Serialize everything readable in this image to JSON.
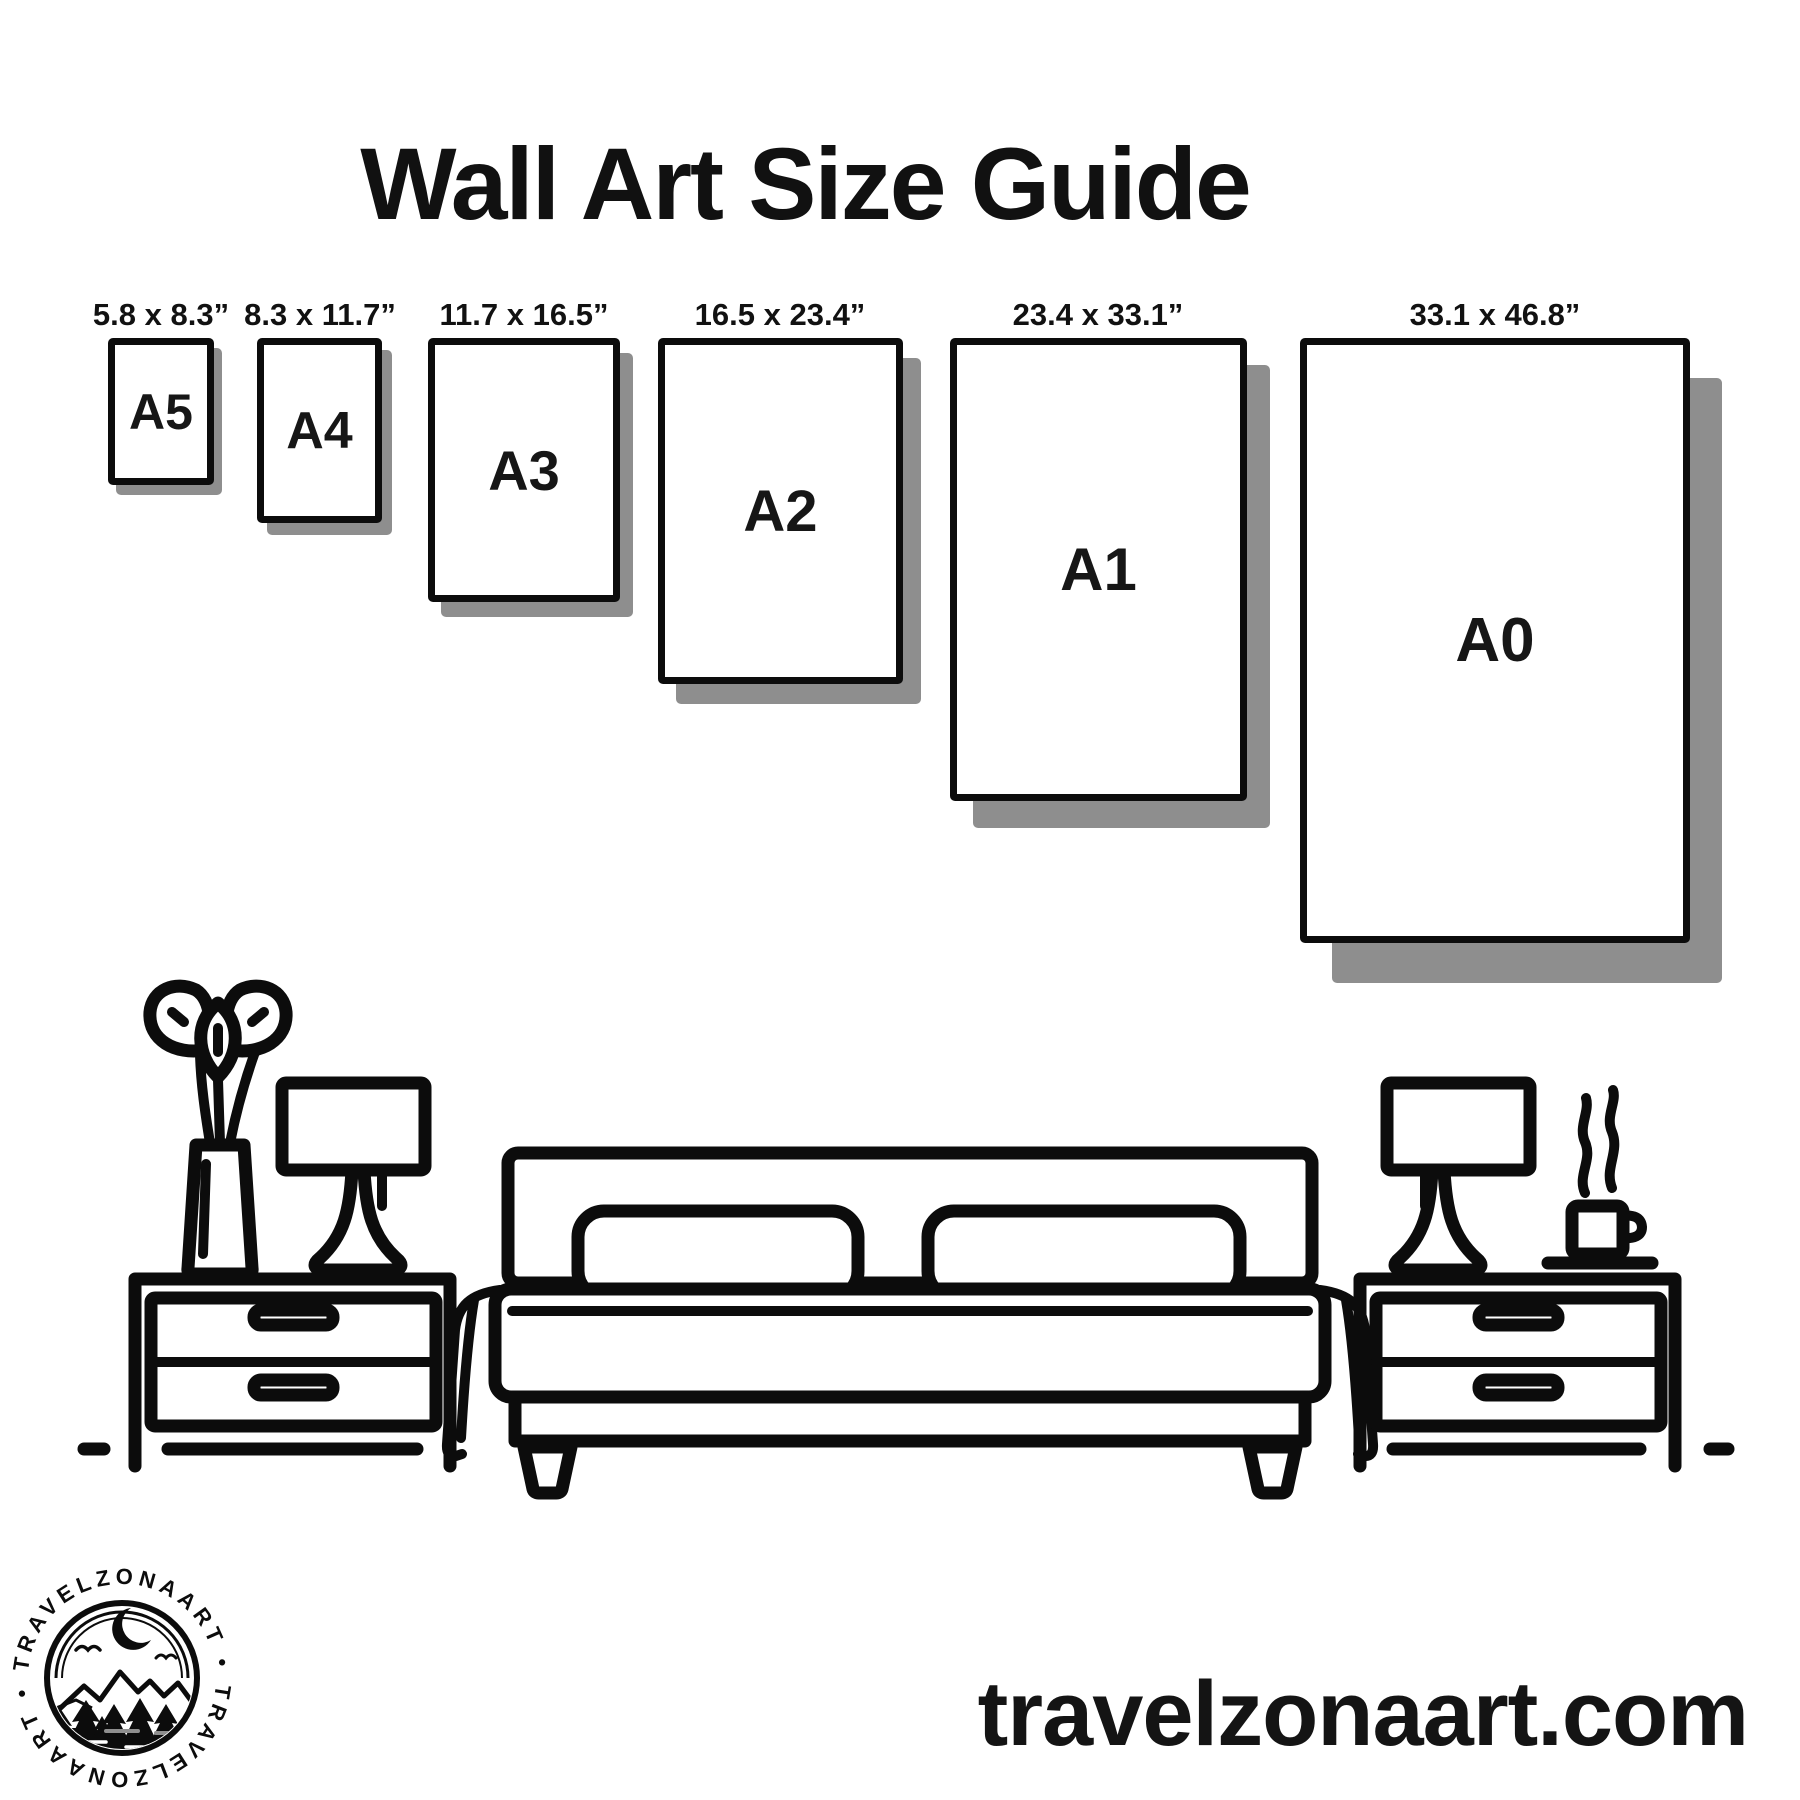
{
  "title": "Wall Art Size Guide",
  "sizes": [
    {
      "name": "A5",
      "dimensions": "5.8 x 8.3”"
    },
    {
      "name": "A4",
      "dimensions": "8.3 x 11.7”"
    },
    {
      "name": "A3",
      "dimensions": "11.7 x 16.5”"
    },
    {
      "name": "A2",
      "dimensions": "16.5 x 23.4”"
    },
    {
      "name": "A1",
      "dimensions": "23.4 x 33.1”"
    },
    {
      "name": "A0",
      "dimensions": "33.1 x 46.8”"
    }
  ],
  "logo": {
    "brand": "TRAVELZONAART",
    "arc_top": "TRAVELZONAART •",
    "arc_bottom": "TRAVELZONAART •"
  },
  "website": "travelzonaart.com",
  "colors": {
    "ink": "#0c0c0c",
    "shadow": "#8e8e8e",
    "background": "#ffffff"
  },
  "icons": [
    "plant-vase-icon",
    "table-lamp-icon",
    "nightstand-icon",
    "bed-icon",
    "pillow-icon",
    "coffee-cup-icon",
    "steam-icon",
    "floor-line-icon",
    "logo-badge-icon",
    "moon-icon",
    "mountain-icon",
    "pine-tree-icon",
    "bird-icon"
  ]
}
